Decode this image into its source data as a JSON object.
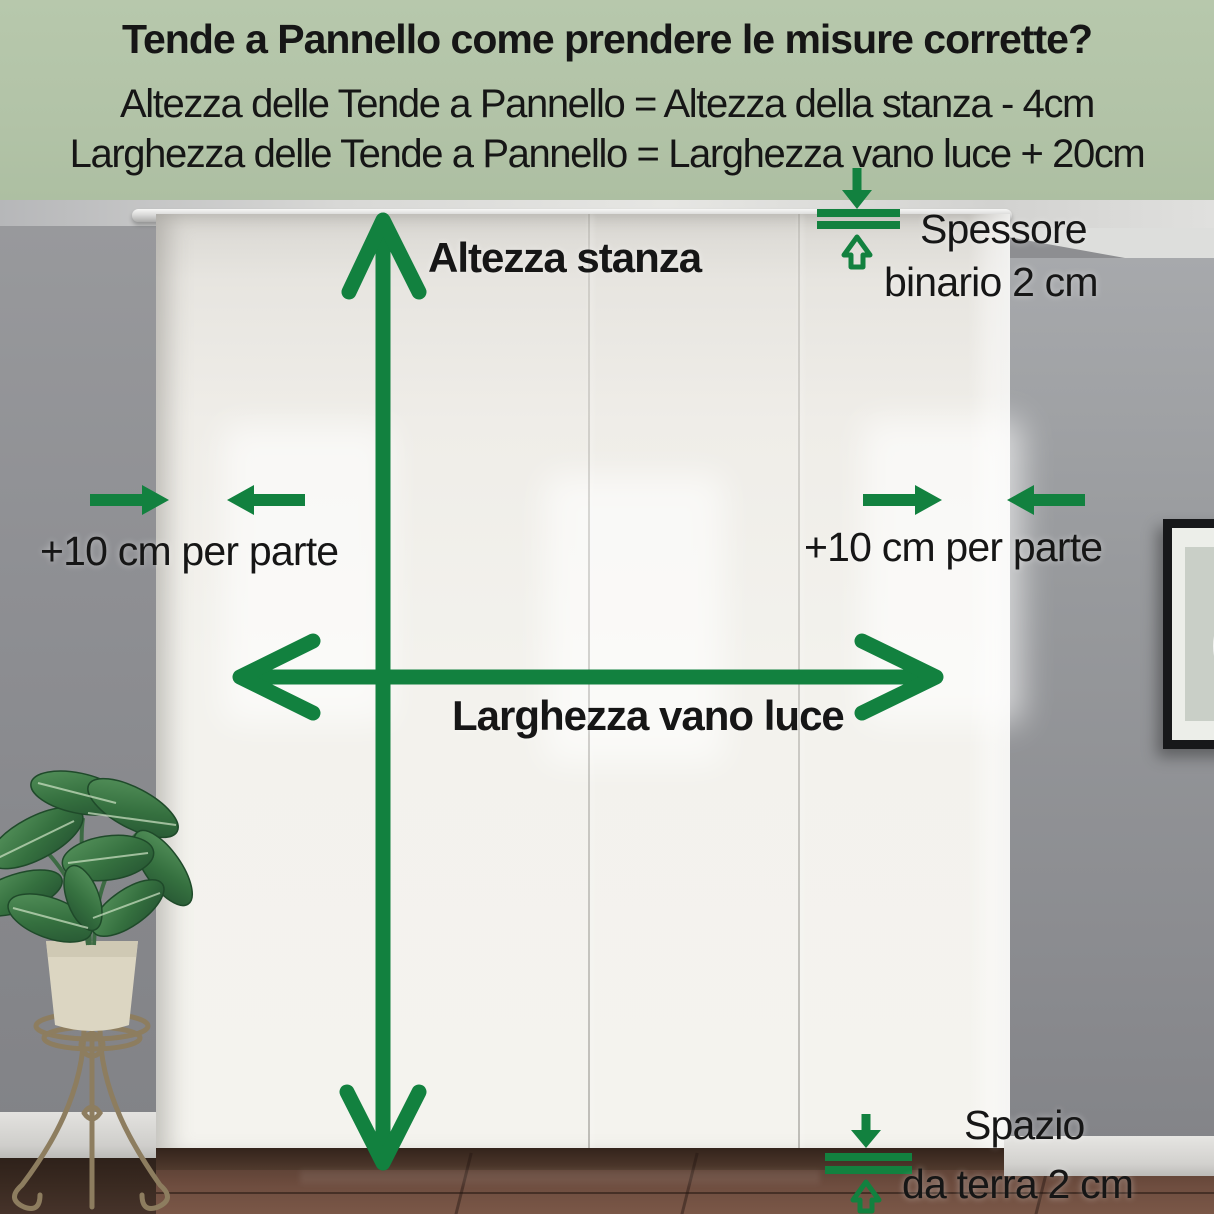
{
  "colors": {
    "banner_bg": "#b2c3a7",
    "arrow_green": "#12813f",
    "text_dark": "#161616"
  },
  "header": {
    "title": "Tende a Pannello come prendere le misure corrette?",
    "formula_height": "Altezza delle Tende a Pannello = Altezza della stanza - 4cm",
    "formula_width": "Larghezza delle Tende a Pannello = Larghezza vano luce + 20cm"
  },
  "labels": {
    "room_height": "Altezza stanza",
    "opening_width": "Larghezza vano luce",
    "left_margin": "+10 cm per parte",
    "right_margin": "+10 cm per parte",
    "track_thickness_line1": "Spessore",
    "track_thickness_line2": "binario 2 cm",
    "floor_gap_line1": "Spazio",
    "floor_gap_line2": "da terra 2 cm"
  }
}
